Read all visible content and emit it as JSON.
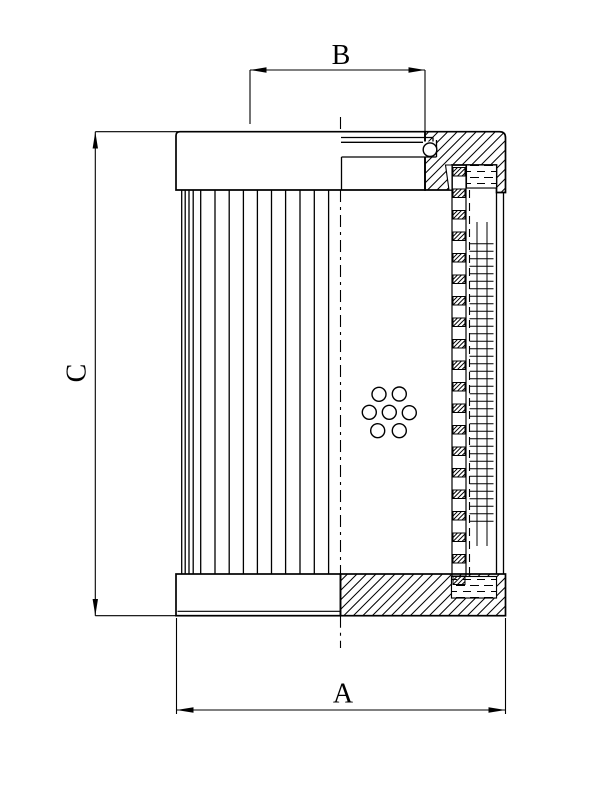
{
  "drawing": {
    "kind": "filter-element-cross-section",
    "labels": {
      "a": "A",
      "b": "B",
      "c": "C"
    },
    "colors": {
      "line": "#000000",
      "background": "#ffffff"
    }
  }
}
